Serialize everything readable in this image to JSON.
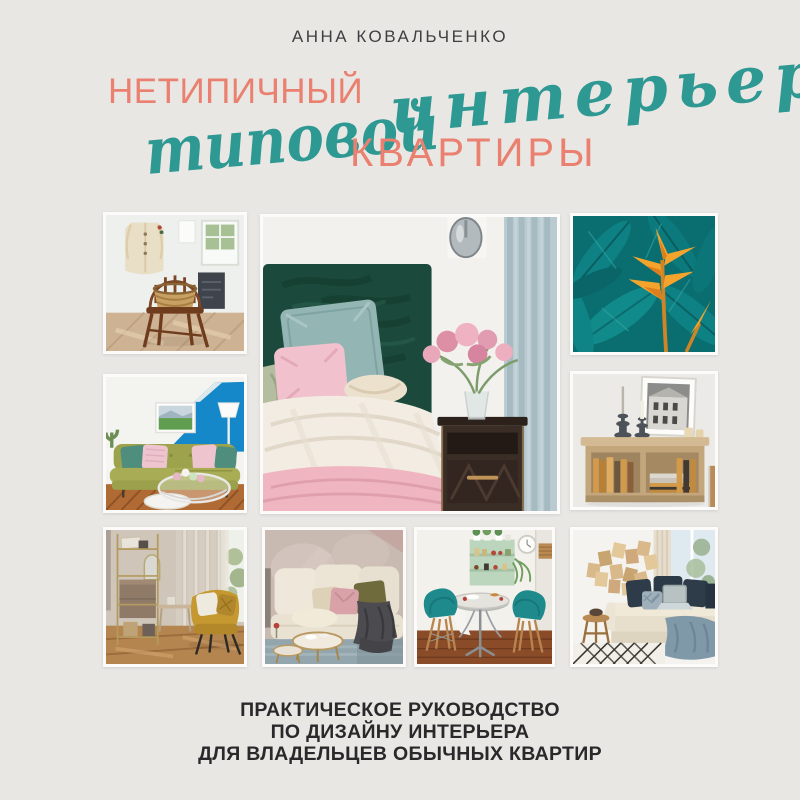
{
  "cover": {
    "author": "АННА КОВАЛЬЧЕНКО",
    "title": {
      "word1": "НЕТИПИЧНЫЙ",
      "word2": "интерьер",
      "word3": "типовой",
      "word4": "КВАРТИРЫ"
    },
    "subtitle": {
      "line1": "ПРАКТИЧЕСКОЕ РУКОВОДСТВО",
      "line2": "ПО ДИЗАЙНУ ИНТЕРЬЕРА",
      "line3": "ДЛЯ ВЛАДЕЛЬЦЕВ ОБЫЧНЫХ КВАРТИР"
    },
    "colors": {
      "background": "#e9e7e3",
      "accent_coral": "#ea8070",
      "accent_teal": "#2e9893",
      "author_text": "#3f3f41",
      "subtitle_text": "#29292b"
    },
    "photos": [
      {
        "name": "photo-chair-with-coat",
        "description": "wooden windsor chair with woven basket, beige coat hanging on white wall"
      },
      {
        "name": "photo-bedroom-green-headboard",
        "description": "bed with dark green velvet headboard, teal and pink pillows, nightstand with pink flowers, blue curtain"
      },
      {
        "name": "photo-tropical-leaves",
        "description": "teal tropical leaves with orange heliconia flower"
      },
      {
        "name": "photo-green-sofa-blue-wall",
        "description": "olive green sofa with pastel cushions, blue geometric accent wall, glass coffee table"
      },
      {
        "name": "photo-wooden-sideboard-books",
        "description": "oak sideboard with books, dark candlesticks and framed black-and-white photo"
      },
      {
        "name": "photo-brass-shelf-yellow-armchair",
        "description": "brass shelving unit and mustard velvet armchair by sheer curtains"
      },
      {
        "name": "photo-cream-sofa-lounge",
        "description": "cream sofa with blush and olive cushions, dark throw, brass coffee tables on gray rug"
      },
      {
        "name": "photo-dining-nook-teal-chairs",
        "description": "bistro table with two teal shell chairs and mint green shelves"
      },
      {
        "name": "photo-daybed-wood-art",
        "description": "cream daybed with navy cushions, laptop, wooden collage wall art and patterned rug"
      }
    ]
  }
}
